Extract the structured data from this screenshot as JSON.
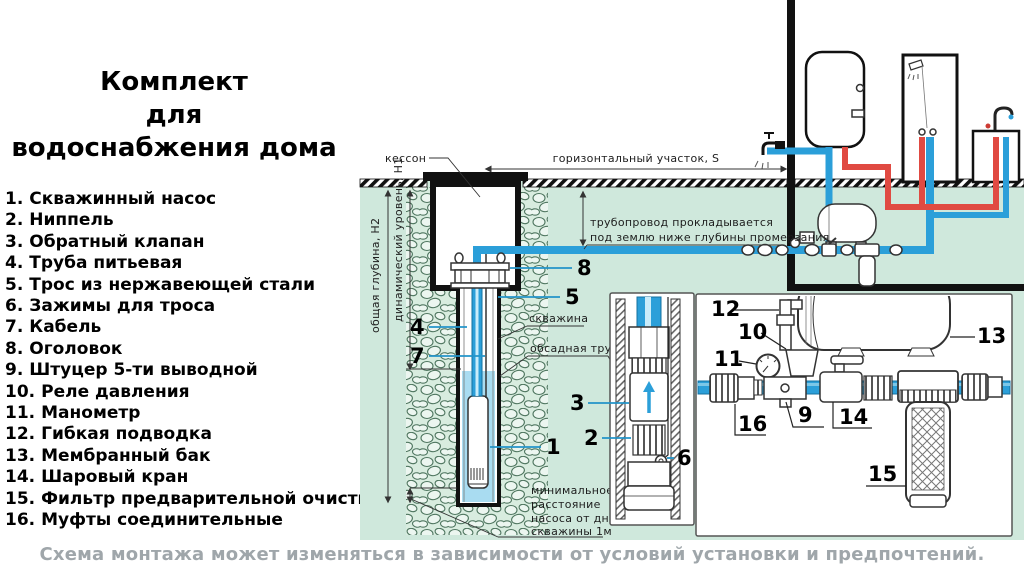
{
  "title": {
    "line1": "Комплект",
    "line2": "для",
    "line3": "водоснабжения дома"
  },
  "legend": {
    "items": [
      {
        "num": "1.",
        "text": "Скважинный насос"
      },
      {
        "num": "2.",
        "text": "Ниппель"
      },
      {
        "num": "3.",
        "text": "Обратный клапан"
      },
      {
        "num": "4.",
        "text": "Труба питьевая"
      },
      {
        "num": "5.",
        "text": "Трос из нержавеющей стали"
      },
      {
        "num": "6.",
        "text": "Зажимы для троса"
      },
      {
        "num": "7.",
        "text": "Кабель"
      },
      {
        "num": "8.",
        "text": "Оголовок"
      },
      {
        "num": "9.",
        "text": "Штуцер 5-ти выводной"
      },
      {
        "num": "10.",
        "text": "Реле давления"
      },
      {
        "num": "11.",
        "text": "Манометр"
      },
      {
        "num": "12.",
        "text": "Гибкая подводка"
      },
      {
        "num": "13.",
        "text": "Мембранный бак"
      },
      {
        "num": "14.",
        "text": "Шаровый кран"
      },
      {
        "num": "15.",
        "text": "Фильтр предварительной очистки"
      },
      {
        "num": "16.",
        "text": "Муфты соединительные"
      }
    ]
  },
  "diagram": {
    "labels": {
      "kesson": "кессон",
      "horizontal": "горизонтальный участок, S",
      "frost1": "трубопровод прокладывается",
      "frost2": "под землю ниже глубины промерзания",
      "well": "скважина",
      "casing": "обсадная труба",
      "min1": "минимальное",
      "min2": "расстояние",
      "min3": "насоса от дна",
      "min4": "скважины 1м",
      "h2": "общая глубина, H2",
      "h1": "динамический уровень, H1"
    },
    "callouts": {
      "c1": "1",
      "c2": "2",
      "c3": "3",
      "c4": "4",
      "c5": "5",
      "c6": "6",
      "c7": "7",
      "c8": "8",
      "c9": "9",
      "c10": "10",
      "c11": "11",
      "c12": "12",
      "c13": "13",
      "c14": "14",
      "c15": "15",
      "c16": "16"
    },
    "colors": {
      "pipe_cold": "#2b9fd9",
      "pipe_hot": "#e04a42",
      "ground": "#cfe8dc",
      "water": "#a9dcf1",
      "stone_line": "#4f7660"
    }
  },
  "caption": {
    "text": "Схема монтажа может изменяться в зависимости от условий установки и предпочтений."
  }
}
